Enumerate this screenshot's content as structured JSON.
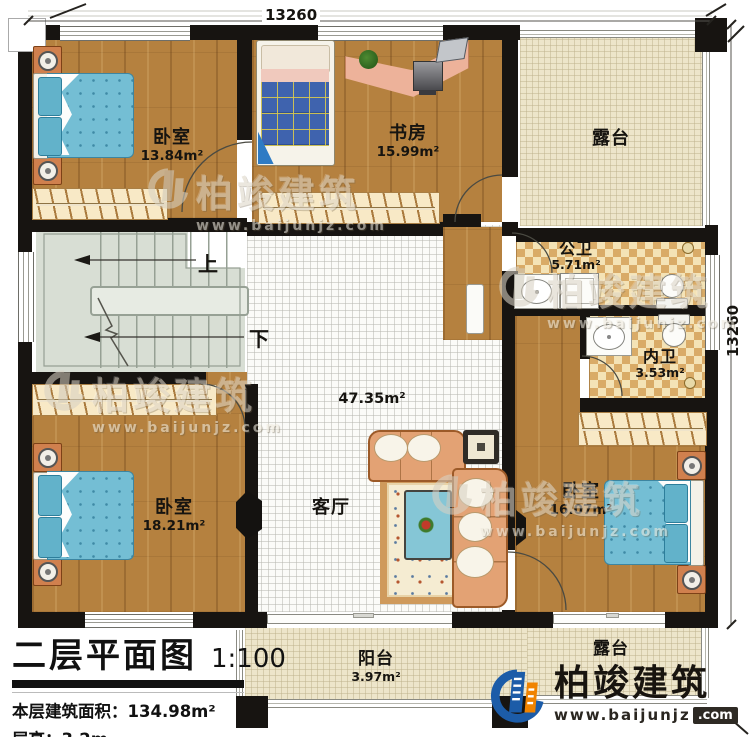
{
  "title_block": {
    "title": "二层平面图",
    "scale": "1:100",
    "area_line": "本层建筑面积：134.98m²",
    "height_line": "层高：3.2m"
  },
  "dimensions": {
    "top": "13260",
    "right": "13260"
  },
  "rooms": {
    "bedroom_tl": {
      "name": "卧室",
      "area": "13.84m²"
    },
    "study": {
      "name": "书房",
      "area": "15.99m²"
    },
    "terrace_top": {
      "name": "露台"
    },
    "public_bath": {
      "name": "公卫",
      "area": "5.71m²"
    },
    "inner_bath": {
      "name": "内卫",
      "area": "3.53m²"
    },
    "living": {
      "name": "客厅",
      "area": "47.35m²"
    },
    "bedroom_bl": {
      "name": "卧室",
      "area": "18.21m²"
    },
    "bedroom_br": {
      "name": "卧室",
      "area": "16.07m²"
    },
    "balcony": {
      "name": "阳台",
      "area": "3.97m²"
    },
    "terrace_bottom": {
      "name": "露台"
    }
  },
  "stairs": {
    "up": "上",
    "down": "下"
  },
  "watermark": {
    "company": "柏竣建筑",
    "website": "www.baijunjz.com"
  },
  "brand": {
    "company": "柏竣建筑",
    "website_base": "www.baijunjz",
    "website_tld": ".com",
    "blue": "#1c5ca8",
    "orange": "#f08300"
  }
}
